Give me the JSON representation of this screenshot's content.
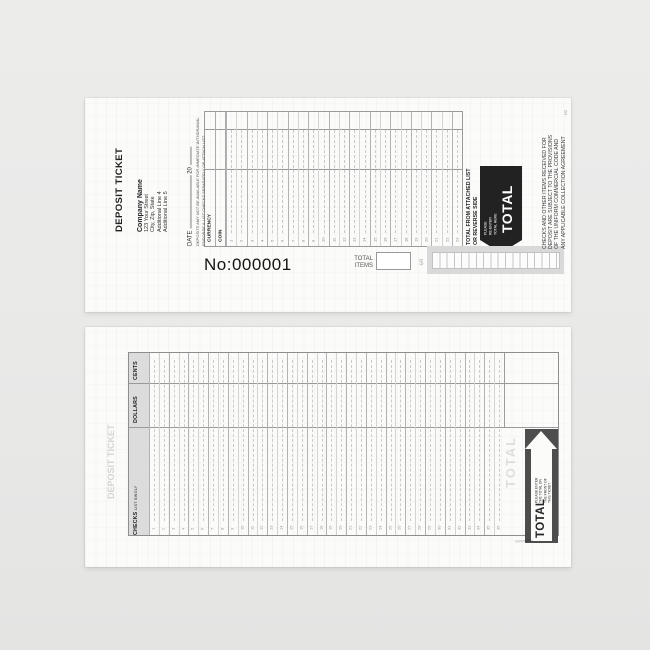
{
  "front": {
    "title": "DEPOSIT TICKET",
    "company_lines": [
      "Company Name",
      "123 Your Street",
      "City, Zip, State",
      "Additional Line 4",
      "Additional Line 5"
    ],
    "date_label": "DATE",
    "date_year": "20",
    "notice_lines": [
      "DEPOSITS MAY NOT BE AVAILABLE FOR IMMEDIATE WITHDRAWAL",
      "ENDORSE & LIST CHECKS SEPARATELY OR ATTACH LIST"
    ],
    "grid": {
      "currency_label": "CURRENCY",
      "coin_label": "COIN",
      "row_numbers": [
        1,
        2,
        3,
        4,
        5,
        6,
        7,
        8,
        9,
        10,
        11,
        12,
        13,
        14,
        15,
        16,
        17,
        18,
        19,
        20,
        21,
        22,
        23
      ]
    },
    "total_from_lines": [
      "TOTAL FROM ATTACHED LIST",
      "OR REVERSE SIDE"
    ],
    "reenter_lines": [
      "PLEASE",
      "RE-ENTER",
      "TOTAL HERE"
    ],
    "total_label": "TOTAL",
    "legal_lines": [
      "CHECKS AND OTHER ITEMS RECEIVED FOR",
      "DEPOSIT ARE SUBJECT TO THE PROVISIONS",
      "OF THE UNIFORM COMMERCIAL CODE AND",
      "ANY APPLICABLE COLLECTION AGREEMENT"
    ],
    "form_code": "D2",
    "ticket_number": "No:000001",
    "total_items_lines": [
      "TOTAL",
      "ITEMS"
    ],
    "currency_symbol": "$"
  },
  "back": {
    "ghost_title": "DEPOSIT TICKET",
    "header": {
      "cents_label": "CENTS",
      "dollars_label": "DOLLARS",
      "checks_label": "CHECKS",
      "checks_sub": "LIST SINGLY"
    },
    "row_numbers": [
      1,
      2,
      3,
      4,
      5,
      6,
      7,
      8,
      9,
      10,
      11,
      12,
      13,
      14,
      15,
      16,
      17,
      18,
      19,
      20,
      21,
      22,
      23,
      24,
      25,
      26,
      27,
      28,
      29,
      30,
      31,
      32,
      33,
      34,
      35,
      36
    ],
    "arrow_note_lines": [
      "PLEASE ENTER",
      "THE TOTAL ON",
      "THE FRONT OF",
      "THIS TICKET"
    ],
    "total_label": "TOTAL",
    "ghost_total": "TOTAL"
  },
  "colors": {
    "page_bg": "#e9e9e8",
    "paper": "#fbfbfa",
    "grid_line": "#9a9a9a",
    "header_fill": "#dcdcdc",
    "front_block": "#222222",
    "back_block": "#4d4d4d"
  }
}
